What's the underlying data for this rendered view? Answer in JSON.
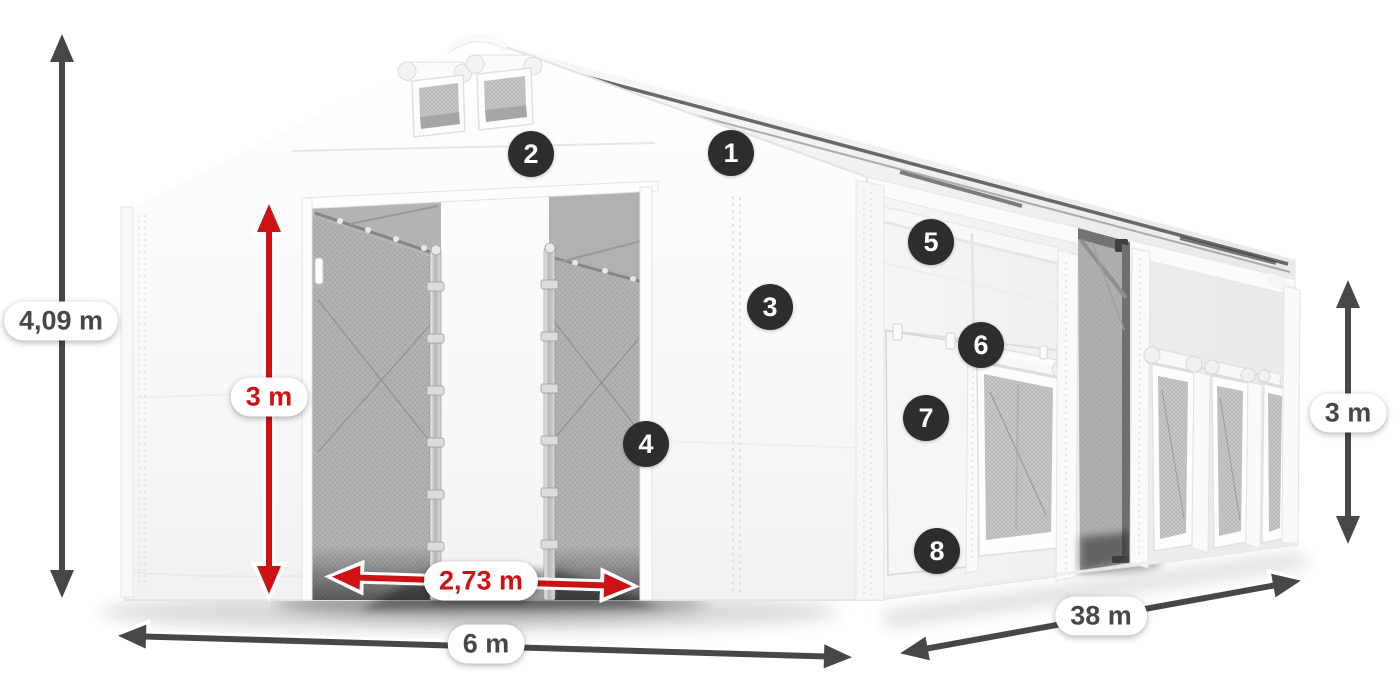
{
  "diagram": {
    "subject": "white storage tent with open front entrance, side door and mesh windows"
  },
  "dimensions": {
    "total_height": "4,09 m",
    "entrance_height": "3 m",
    "entrance_width": "2,73 m",
    "width": "6 m",
    "length": "38 m",
    "side_height": "3 m"
  },
  "markers": [
    {
      "label": "1"
    },
    {
      "label": "2"
    },
    {
      "label": "3"
    },
    {
      "label": "4"
    },
    {
      "label": "5"
    },
    {
      "label": "6"
    },
    {
      "label": "7"
    },
    {
      "label": "8"
    }
  ],
  "colors": {
    "accent_red": "#cc1212",
    "arrow_gray": "#474748",
    "badge_bg": "#2d2d2e",
    "tent_white": "#fafafa",
    "mesh_gray": "#bcbdbf"
  }
}
